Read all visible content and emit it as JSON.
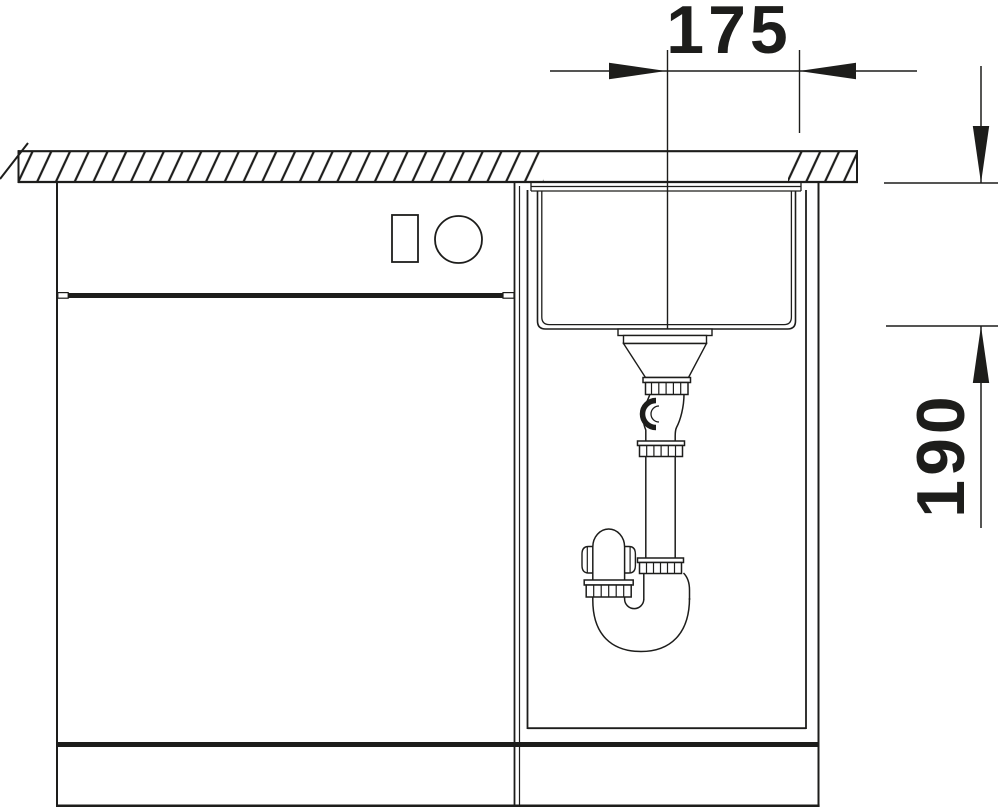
{
  "diagram": {
    "type": "sink-installation-section-drawing",
    "background": "#ffffff",
    "line_color": "#1d1d1b",
    "labels": {
      "width_dimension": "175",
      "depth_dimension": "190"
    }
  }
}
